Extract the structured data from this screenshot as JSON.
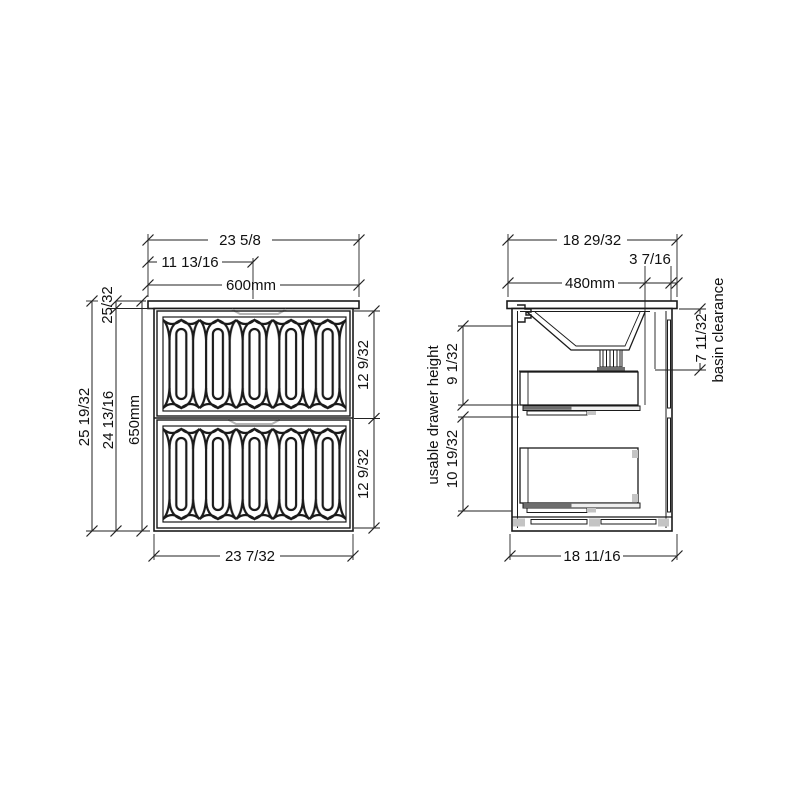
{
  "drawing": {
    "background": "#ffffff",
    "line_color": "#1a1a1a",
    "accent_gray": "#b5b5b5"
  },
  "front_view": {
    "dims": {
      "width_total_in": "23 5/8",
      "width_center_in": "11 13/16",
      "width_mm": "600mm",
      "countertop_thickness_in": "25/32",
      "height_total_in": "25 19/32",
      "height_cabinet_in": "24 13/16",
      "height_mm": "650mm",
      "drawer_top_front_in": "12 9/32",
      "drawer_bottom_front_in": "12 9/32",
      "width_cabinet_in": "23 7/32"
    }
  },
  "side_view": {
    "dims": {
      "depth_total_in": "18 29/32",
      "depth_mm": "480mm",
      "tap_ledge_in": "3 7/16",
      "basin_clearance_in": "7 11/32",
      "basin_clearance_label": "basin clearance",
      "usable_drawer_label": "usable drawer height",
      "top_drawer_usable_in": "9 1/32",
      "bottom_drawer_usable_in": "10 19/32",
      "depth_cabinet_in": "18 11/16"
    }
  }
}
